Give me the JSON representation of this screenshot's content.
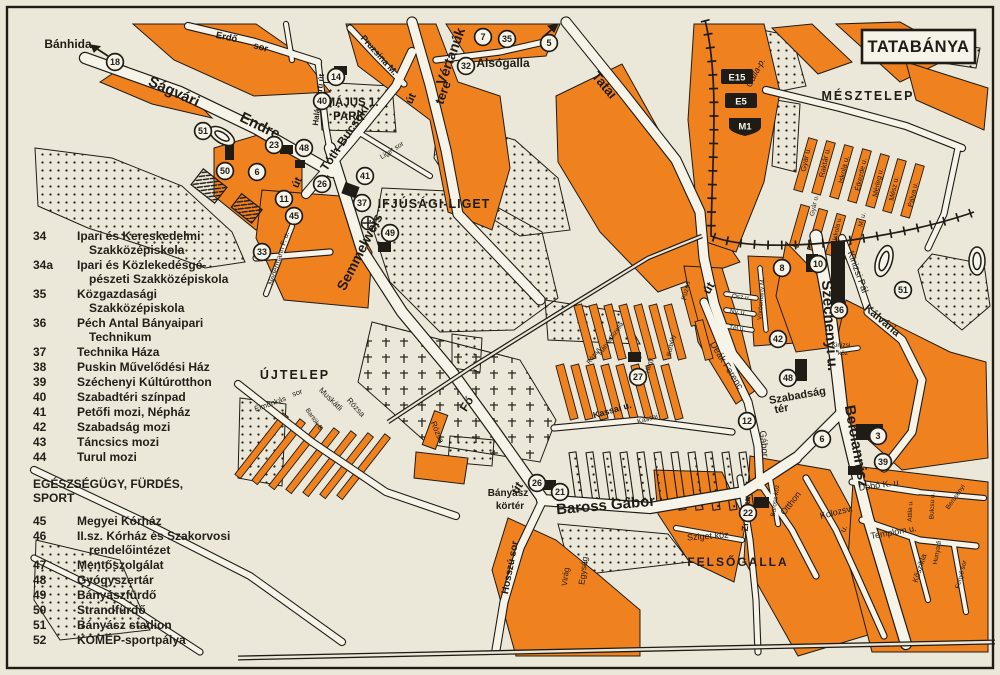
{
  "title": "TATABÁNYA",
  "colors": {
    "orange": "#f0811f",
    "background": "#ece8d9",
    "ink": "#1f1c15",
    "road": "#f6f3e9"
  },
  "legend": {
    "section1_items": [
      {
        "num": "34",
        "label": "Ipari és Kereskedelmi Szakközépiskola"
      },
      {
        "num": "34a",
        "label": "Ipari és Közlekedésgé-pészeti Szakközépiskola"
      },
      {
        "num": "35",
        "label": "Közgazdasági Szakközépiskola"
      },
      {
        "num": "36",
        "label": "Péch Antal Bányaipari Technikum"
      },
      {
        "num": "37",
        "label": "Technika Háza"
      },
      {
        "num": "38",
        "label": "Puskin Művelődési Ház"
      },
      {
        "num": "39",
        "label": "Széchenyi Kúltúrotthon"
      },
      {
        "num": "40",
        "label": "Szabadtéri színpad"
      },
      {
        "num": "41",
        "label": "Petőfi mozi, Népház"
      },
      {
        "num": "42",
        "label": "Szabadság mozi"
      },
      {
        "num": "43",
        "label": "Táncsics mozi"
      },
      {
        "num": "44",
        "label": "Turul mozi"
      }
    ],
    "section2_header": "EGÉSZSÉGÜGY, FÜRDÉS, SPORT",
    "section2_items": [
      {
        "num": "45",
        "label": "Megyei Kórház"
      },
      {
        "num": "46",
        "label": "II.sz. Kórház és Szakorvosi rendelőintézet"
      },
      {
        "num": "47",
        "label": "Mentőszolgálat"
      },
      {
        "num": "48",
        "label": "Gyógyszertár"
      },
      {
        "num": "49",
        "label": "Bányászfürdő"
      },
      {
        "num": "50",
        "label": "Strandfürdő"
      },
      {
        "num": "51",
        "label": "Bányász stadion"
      },
      {
        "num": "52",
        "label": "KOMÉP-sportpálya"
      }
    ]
  },
  "map": {
    "shields": [
      {
        "label": "E15",
        "x": 737,
        "y": 77,
        "shape": "rect"
      },
      {
        "label": "E5",
        "x": 741,
        "y": 101,
        "shape": "rect"
      },
      {
        "label": "M1",
        "x": 745,
        "y": 126,
        "shape": "shield"
      }
    ],
    "places": [
      {
        "t": "Bánhida",
        "x": 68,
        "y": 48,
        "r": 0,
        "s": 12,
        "w": 1
      },
      {
        "t": "Alsógalla",
        "x": 503,
        "y": 67,
        "r": 0,
        "s": 12,
        "w": 1
      },
      {
        "t": "MÉSZTELEP",
        "x": 868,
        "y": 100,
        "r": 0,
        "s": 12.5,
        "w": 1,
        "ls": 2
      },
      {
        "t": "ÚJTELEP",
        "x": 295,
        "y": 379,
        "r": 0,
        "s": 12.5,
        "w": 1,
        "ls": 2
      },
      {
        "t": "FELSŐGALLA",
        "x": 738,
        "y": 566,
        "r": 0,
        "s": 12,
        "w": 1,
        "ls": 2
      },
      {
        "t": "IFJÚSÁGI-LIGET",
        "x": 434,
        "y": 208,
        "r": 0,
        "s": 12.5,
        "w": 1,
        "ls": 1
      },
      {
        "t": "MÁJUS 1.",
        "x": 352,
        "y": 106,
        "r": 0,
        "s": 11.5,
        "w": 1
      },
      {
        "t": "PARK",
        "x": 349,
        "y": 120,
        "r": 0,
        "s": 11.5,
        "w": 1
      },
      {
        "t": "Szabadság",
        "x": 798,
        "y": 399,
        "r": -10,
        "s": 11,
        "w": 1
      },
      {
        "t": "tér",
        "x": 782,
        "y": 412,
        "r": -10,
        "s": 11,
        "w": 1
      },
      {
        "t": "Bányász",
        "x": 508,
        "y": 496,
        "r": 0,
        "s": 10,
        "w": 1
      },
      {
        "t": "körtér",
        "x": 510,
        "y": 509,
        "r": 0,
        "s": 10,
        "w": 1
      }
    ],
    "streets": [
      {
        "t": "Ságvári",
        "x": 172,
        "y": 96,
        "r": 24,
        "s": 15,
        "w": 1
      },
      {
        "t": "Endre",
        "x": 258,
        "y": 130,
        "r": 26,
        "s": 15,
        "w": 1
      },
      {
        "t": "Erdő",
        "x": 226,
        "y": 40,
        "r": 12,
        "s": 9.5,
        "w": 1
      },
      {
        "t": "sor",
        "x": 260,
        "y": 50,
        "r": 16,
        "s": 9.5,
        "w": 1
      },
      {
        "t": "Halászkerti út",
        "x": 321,
        "y": 100,
        "r": -83,
        "s": 8,
        "w": 1
      },
      {
        "t": "Pruzsina M.",
        "x": 377,
        "y": 57,
        "r": 48,
        "s": 9,
        "w": 1
      },
      {
        "t": "Vértanúk",
        "x": 455,
        "y": 58,
        "r": -70,
        "s": 14,
        "w": 1
      },
      {
        "t": "tere",
        "x": 447,
        "y": 94,
        "r": -70,
        "s": 13,
        "w": 1
      },
      {
        "t": "út",
        "x": 414,
        "y": 100,
        "r": -65,
        "s": 11,
        "w": 1
      },
      {
        "t": "Tatai",
        "x": 601,
        "y": 88,
        "r": 50,
        "s": 13.5,
        "w": 1
      },
      {
        "t": "Tóth-Bucsoki",
        "x": 348,
        "y": 140,
        "r": -56,
        "s": 12,
        "w": 1
      },
      {
        "t": "Semmelweis",
        "x": 364,
        "y": 254,
        "r": -63,
        "s": 14,
        "w": 1
      },
      {
        "t": "út",
        "x": 300,
        "y": 184,
        "r": -65,
        "s": 11,
        "w": 1
      },
      {
        "t": "Nedermann F. u.",
        "x": 281,
        "y": 259,
        "r": -73,
        "s": 7.5,
        "w": 0
      },
      {
        "t": "Liget sor",
        "x": 393,
        "y": 152,
        "r": -33,
        "s": 7,
        "w": 0
      },
      {
        "t": "Fő",
        "x": 470,
        "y": 406,
        "r": -58,
        "s": 12,
        "w": 1
      },
      {
        "t": "út",
        "x": 520,
        "y": 490,
        "r": -55,
        "s": 12,
        "w": 1
      },
      {
        "t": "Baross Gábor",
        "x": 606,
        "y": 510,
        "r": -5,
        "s": 15,
        "w": 1
      },
      {
        "t": "Hosszú sor",
        "x": 513,
        "y": 568,
        "r": -79,
        "s": 10,
        "w": 1
      },
      {
        "t": "Virág",
        "x": 568,
        "y": 577,
        "r": -83,
        "s": 8,
        "w": 0
      },
      {
        "t": "Egység",
        "x": 586,
        "y": 571,
        "r": -83,
        "s": 8.5,
        "w": 0
      },
      {
        "t": "Sziget köz",
        "x": 708,
        "y": 539,
        "r": -4,
        "s": 9,
        "w": 0
      },
      {
        "t": "Zrínyi u.",
        "x": 749,
        "y": 514,
        "r": -86,
        "s": 9,
        "w": 1
      },
      {
        "t": "Baross köz",
        "x": 777,
        "y": 501,
        "r": -82,
        "s": 6.5,
        "w": 0
      },
      {
        "t": "Otthon",
        "x": 793,
        "y": 505,
        "r": -52,
        "s": 9,
        "w": 0
      },
      {
        "t": "Kolozsv.",
        "x": 837,
        "y": 515,
        "r": -14,
        "s": 9,
        "w": 0
      },
      {
        "t": "u.",
        "x": 846,
        "y": 530,
        "r": -60,
        "s": 8,
        "w": 0
      },
      {
        "t": "Dobó K. u",
        "x": 879,
        "y": 488,
        "r": -8,
        "s": 9,
        "w": 0
      },
      {
        "t": "Templom u.",
        "x": 894,
        "y": 535,
        "r": -10,
        "s": 9,
        "w": 0
      },
      {
        "t": "Kőszikla",
        "x": 922,
        "y": 569,
        "r": -72,
        "s": 8,
        "w": 0
      },
      {
        "t": "Hunyadi",
        "x": 939,
        "y": 553,
        "r": -80,
        "s": 6.5,
        "w": 0
      },
      {
        "t": "Attila u.",
        "x": 912,
        "y": 511,
        "r": -88,
        "s": 6.5,
        "w": 0
      },
      {
        "t": "Bulcsu u.",
        "x": 934,
        "y": 506,
        "r": -88,
        "s": 6.5,
        "w": 0
      },
      {
        "t": "Bercsényi",
        "x": 957,
        "y": 498,
        "r": -55,
        "s": 6.5,
        "w": 0
      },
      {
        "t": "Fenyő sor",
        "x": 963,
        "y": 575,
        "r": -75,
        "s": 6.5,
        "w": 0
      },
      {
        "t": "Gábor",
        "x": 761,
        "y": 444,
        "r": 84,
        "s": 9.5,
        "w": 0
      },
      {
        "t": "Deák Ferenc",
        "x": 724,
        "y": 367,
        "r": 58,
        "s": 9.5,
        "w": 0
      },
      {
        "t": "út",
        "x": 712,
        "y": 290,
        "r": -60,
        "s": 12,
        "w": 1
      },
      {
        "t": "Ősz u.",
        "x": 741,
        "y": 299,
        "r": 6,
        "s": 6.5,
        "w": 0
      },
      {
        "t": "Ny. u.",
        "x": 738,
        "y": 314,
        "r": 6,
        "s": 6.5,
        "w": 0
      },
      {
        "t": "Tél u.",
        "x": 737,
        "y": 330,
        "r": 6,
        "s": 6.5,
        "w": 0
      },
      {
        "t": "Vörösmarty M.",
        "x": 763,
        "y": 299,
        "r": -86,
        "s": 6.5,
        "w": 0
      },
      {
        "t": "Széchenyi u.",
        "x": 825,
        "y": 326,
        "r": 86,
        "s": 15,
        "w": 1
      },
      {
        "t": "Beloiannisz",
        "x": 852,
        "y": 447,
        "r": 80,
        "s": 15,
        "w": 1
      },
      {
        "t": "Kinizsi Pál",
        "x": 855,
        "y": 273,
        "r": 70,
        "s": 9.5,
        "w": 0
      },
      {
        "t": "Kálvária",
        "x": 880,
        "y": 323,
        "r": 40,
        "s": 11,
        "w": 1
      },
      {
        "t": "Kinizsi",
        "x": 841,
        "y": 347,
        "r": 0,
        "s": 6.5,
        "w": 0
      },
      {
        "t": "köz",
        "x": 843,
        "y": 355,
        "r": 0,
        "s": 6.5,
        "w": 0
      },
      {
        "t": "Kassai u.",
        "x": 613,
        "y": 413,
        "r": -16,
        "s": 9,
        "w": 1
      },
      {
        "t": "Kassai",
        "x": 648,
        "y": 421,
        "r": -16,
        "s": 7,
        "w": 0
      },
      {
        "t": "Füzes",
        "x": 688,
        "y": 291,
        "r": -78,
        "s": 7,
        "w": 0
      },
      {
        "t": "Borbély",
        "x": 673,
        "y": 346,
        "r": -78,
        "s": 6.5,
        "w": 0
      },
      {
        "t": "Hegy",
        "x": 651,
        "y": 366,
        "r": -78,
        "s": 6.5,
        "w": 0
      },
      {
        "t": "Gizella",
        "x": 618,
        "y": 332,
        "r": -55,
        "s": 6.5,
        "w": 0
      },
      {
        "t": "Mátyás",
        "x": 607,
        "y": 347,
        "r": -55,
        "s": 6.5,
        "w": 0
      },
      {
        "t": "Rózsa",
        "x": 595,
        "y": 357,
        "r": -55,
        "s": 6.5,
        "w": 0
      },
      {
        "t": "Élmunkás",
        "x": 271,
        "y": 406,
        "r": -20,
        "s": 7.5,
        "w": 0
      },
      {
        "t": "sor",
        "x": 298,
        "y": 395,
        "r": -20,
        "s": 7.5,
        "w": 0
      },
      {
        "t": "Muskátli",
        "x": 329,
        "y": 401,
        "r": 44,
        "s": 8,
        "w": 0
      },
      {
        "t": "Rózsa",
        "x": 354,
        "y": 409,
        "r": 48,
        "s": 8,
        "w": 0
      },
      {
        "t": "Bartók B.",
        "x": 313,
        "y": 421,
        "r": 55,
        "s": 6.5,
        "w": 0
      },
      {
        "t": "Rózsa",
        "x": 435,
        "y": 433,
        "r": 68,
        "s": 8,
        "w": 0
      },
      {
        "t": "Gyár u.",
        "x": 808,
        "y": 160,
        "r": -78,
        "s": 7.5,
        "w": 0
      },
      {
        "t": "Raktár u.",
        "x": 827,
        "y": 163,
        "r": -78,
        "s": 7.5,
        "w": 0
      },
      {
        "t": "Iskola u.",
        "x": 846,
        "y": 170,
        "r": -78,
        "s": 7.5,
        "w": 0
      },
      {
        "t": "Étkezde u.",
        "x": 863,
        "y": 175,
        "r": -78,
        "s": 7,
        "w": 0
      },
      {
        "t": "Mérleg u.",
        "x": 880,
        "y": 183,
        "r": -78,
        "s": 7,
        "w": 0
      },
      {
        "t": "Mész u.",
        "x": 896,
        "y": 189,
        "r": -78,
        "s": 7,
        "w": 0
      },
      {
        "t": "Pálya u.",
        "x": 915,
        "y": 195,
        "r": -78,
        "s": 7,
        "w": 0
      },
      {
        "t": "Gyár u.",
        "x": 816,
        "y": 206,
        "r": -78,
        "s": 6.5,
        "w": 0
      },
      {
        "t": "Iskola u.",
        "x": 839,
        "y": 229,
        "r": -78,
        "s": 6.5,
        "w": 0
      },
      {
        "t": "M. u.",
        "x": 864,
        "y": 220,
        "r": -78,
        "s": 6.5,
        "w": 0
      },
      {
        "t": "Galla-p.",
        "x": 758,
        "y": 74,
        "r": -62,
        "s": 9,
        "w": 0,
        "i": 1
      }
    ],
    "markers": [
      {
        "n": "18",
        "x": 115,
        "y": 62
      },
      {
        "n": "51",
        "x": 203,
        "y": 131
      },
      {
        "n": "50",
        "x": 225,
        "y": 171
      },
      {
        "n": "6",
        "x": 257,
        "y": 172
      },
      {
        "n": "23",
        "x": 274,
        "y": 145
      },
      {
        "n": "48",
        "x": 304,
        "y": 148
      },
      {
        "n": "40",
        "x": 322,
        "y": 101
      },
      {
        "n": "14",
        "x": 336,
        "y": 77
      },
      {
        "n": "26",
        "x": 322,
        "y": 184
      },
      {
        "n": "11",
        "x": 284,
        "y": 199
      },
      {
        "n": "45",
        "x": 294,
        "y": 216
      },
      {
        "n": "41",
        "x": 365,
        "y": 176
      },
      {
        "n": "37",
        "x": 362,
        "y": 203
      },
      {
        "n": "33",
        "x": 262,
        "y": 252
      },
      {
        "n": "49",
        "x": 390,
        "y": 233
      },
      {
        "n": "7",
        "x": 483,
        "y": 37
      },
      {
        "n": "35",
        "x": 507,
        "y": 39
      },
      {
        "n": "32",
        "x": 466,
        "y": 66
      },
      {
        "n": "5",
        "x": 549,
        "y": 43
      },
      {
        "n": "8",
        "x": 782,
        "y": 268
      },
      {
        "n": "10",
        "x": 818,
        "y": 264
      },
      {
        "n": "51",
        "x": 903,
        "y": 290
      },
      {
        "n": "36",
        "x": 839,
        "y": 310
      },
      {
        "n": "42",
        "x": 778,
        "y": 339
      },
      {
        "n": "48",
        "x": 788,
        "y": 378
      },
      {
        "n": "27",
        "x": 638,
        "y": 377
      },
      {
        "n": "12",
        "x": 747,
        "y": 421
      },
      {
        "n": "6",
        "x": 822,
        "y": 439
      },
      {
        "n": "3",
        "x": 878,
        "y": 436
      },
      {
        "n": "39",
        "x": 883,
        "y": 462
      },
      {
        "n": "26",
        "x": 537,
        "y": 483
      },
      {
        "n": "21",
        "x": 560,
        "y": 492
      },
      {
        "n": "22",
        "x": 748,
        "y": 513
      }
    ]
  }
}
